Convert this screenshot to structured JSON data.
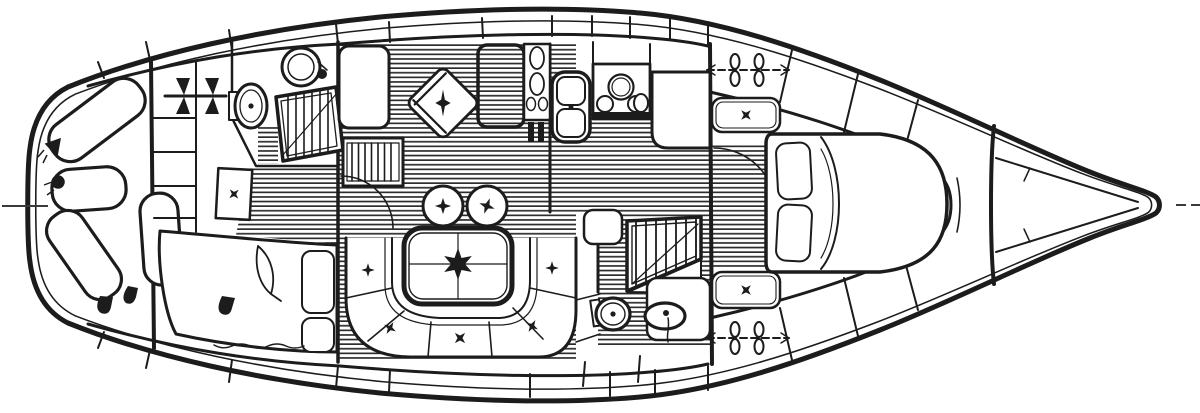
{
  "meta": {
    "type": "yacht-interior-floor-plan",
    "view": "overhead-deck-plan",
    "style": "black-and-white line drawing"
  },
  "canvas": {
    "width": 1200,
    "height": 413
  },
  "colors": {
    "ink": "#1c1c1c",
    "paper": "#ffffff",
    "sole_stripe": "#2d2d2d",
    "grid_fill": "#c9c9c9",
    "centerline": "#3a3a3a"
  },
  "regions": [
    {
      "id": "forepeak",
      "label": "Forepeak sail storage with four sail bags"
    },
    {
      "id": "fwd-cabin",
      "label": "Forward cabin with double berth, shelves and lockers"
    },
    {
      "id": "fwd-head",
      "label": "Forward head with toilet, sink and shower grating"
    },
    {
      "id": "salon",
      "label": "Main salon with U-shaped settee, table, two stools and swivel chair"
    },
    {
      "id": "galley",
      "label": "Galley with double sink, three-burner stove, icebox and counters"
    },
    {
      "id": "aft-head",
      "label": "Aft head with toilet, sink and shower grating"
    },
    {
      "id": "aft-cabin",
      "label": "Aft stateroom with double berth, pillows and seats"
    },
    {
      "id": "aft-deck",
      "label": "Aft deck tapering to canoe stern"
    }
  ],
  "fixtures": [
    "sail-bag",
    "boat-hull",
    "toilet-icon",
    "sink-icon",
    "shower-grate-icon",
    "stove-burners-icon",
    "double-sink-icon",
    "icebox-panel-icon",
    "dinette-table",
    "settee-cushions",
    "stool-seat",
    "swivel-chair",
    "double-berth",
    "pillow",
    "deck-cleat-icon",
    "door-swing-arc",
    "centerline-mark"
  ]
}
